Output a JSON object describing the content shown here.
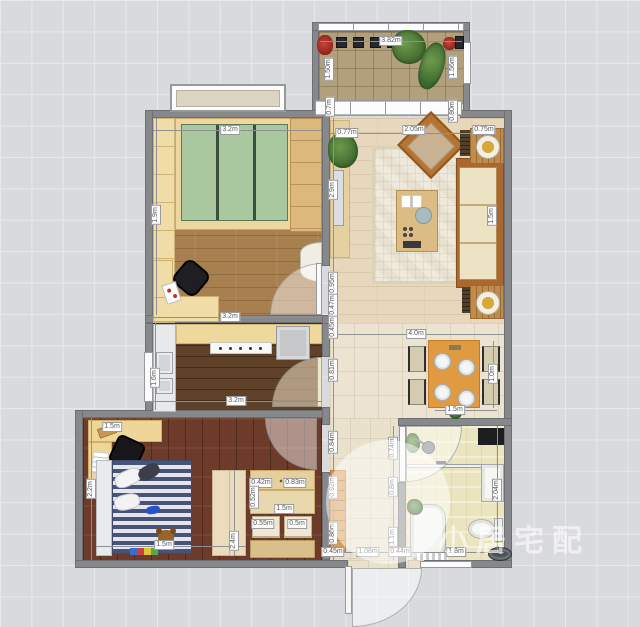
{
  "watermark": {
    "text": "小居宅配"
  },
  "colors": {
    "wall": "#87888c",
    "background_grid": "#d9dadd",
    "balcony_floor": "#b2a07c",
    "living_floor": "#e7d8bd",
    "dining_floor": "#ece4d1",
    "study_floor": "#a87f4f",
    "kitchen_floor": "#5f4129",
    "bedroom_floor": "#6e3b2a",
    "bathroom_floor": "#ebe5bf",
    "hall_floor": "#e9e1cb",
    "wardrobe_green": "#a9c8a0",
    "dining_table_orange": "#e09a42",
    "bed_stripe_blue": "#46537a",
    "watermark_white": "rgba(255,255,255,0.58)"
  },
  "furniture_icons": [
    "potted-plant-icon",
    "flower-pot-icon",
    "wardrobe-icon",
    "desk-icon",
    "office-chair-icon",
    "bay-window-icon",
    "tv-icon",
    "tv-console-icon",
    "rug-icon",
    "coffee-table-icon",
    "armchair-icon",
    "sofa-icon",
    "side-table-bowl-icon",
    "dining-table-icon",
    "dining-chair-icon",
    "plate-icon",
    "sink-icon",
    "stove-icon",
    "fridge-icon",
    "counter-icon",
    "bed-icon",
    "pillow-icon",
    "teddy-bear-icon",
    "toy-blocks-icon",
    "slipper-icon",
    "shoe-cabinet-icon",
    "door-swing-icon",
    "entry-door-icon",
    "shower-head-icon",
    "glass-partition-icon",
    "vanity-cabinet-icon",
    "toilet-icon",
    "washing-machine-icon",
    "bath-mat-icon",
    "floor-sink-icon",
    "window-icon"
  ],
  "dim_labels": [
    {
      "text": "3.82m",
      "x": 391,
      "y": 41,
      "v": false
    },
    {
      "text": "1.50m",
      "x": 329,
      "y": 69,
      "v": true
    },
    {
      "text": "1.56m",
      "x": 453,
      "y": 67,
      "v": true
    },
    {
      "text": "0.7m",
      "x": 330,
      "y": 107,
      "v": true
    },
    {
      "text": "0.80m",
      "x": 453,
      "y": 111,
      "v": true
    },
    {
      "text": "3.2m",
      "x": 230,
      "y": 130,
      "v": false
    },
    {
      "text": "3.2m",
      "x": 230,
      "y": 317,
      "v": false
    },
    {
      "text": "1.9m",
      "x": 156,
      "y": 215,
      "v": true
    },
    {
      "text": "0.77m",
      "x": 347,
      "y": 133,
      "v": false
    },
    {
      "text": "2.05m",
      "x": 414,
      "y": 130,
      "v": false
    },
    {
      "text": "0.75m",
      "x": 484,
      "y": 130,
      "v": false
    },
    {
      "text": "2.9m",
      "x": 333,
      "y": 190,
      "v": true
    },
    {
      "text": "1.5m",
      "x": 492,
      "y": 216,
      "v": true
    },
    {
      "text": "0.95m",
      "x": 333,
      "y": 283,
      "v": true
    },
    {
      "text": "0.47m",
      "x": 333,
      "y": 305,
      "v": true
    },
    {
      "text": "0.45m",
      "x": 333,
      "y": 327,
      "v": true
    },
    {
      "text": "0.81m",
      "x": 333,
      "y": 370,
      "v": true
    },
    {
      "text": "0.84m",
      "x": 333,
      "y": 442,
      "v": true
    },
    {
      "text": "0.92m",
      "x": 333,
      "y": 487,
      "v": true
    },
    {
      "text": "0.86m",
      "x": 333,
      "y": 533,
      "v": true
    },
    {
      "text": "4.0m",
      "x": 416,
      "y": 334,
      "v": false
    },
    {
      "text": "1.0m",
      "x": 493,
      "y": 374,
      "v": true
    },
    {
      "text": "1.5m",
      "x": 455,
      "y": 410,
      "v": false
    },
    {
      "text": "3.2m",
      "x": 236,
      "y": 401,
      "v": false
    },
    {
      "text": "1.6m",
      "x": 155,
      "y": 378,
      "v": true
    },
    {
      "text": "1.5m",
      "x": 112,
      "y": 427,
      "v": false
    },
    {
      "text": "2.2m",
      "x": 91,
      "y": 489,
      "v": true
    },
    {
      "text": "1.5m",
      "x": 164,
      "y": 545,
      "v": false
    },
    {
      "text": "2.4m",
      "x": 234,
      "y": 541,
      "v": true
    },
    {
      "text": "0.42m",
      "x": 261,
      "y": 483,
      "v": false
    },
    {
      "text": "0.83m",
      "x": 295,
      "y": 483,
      "v": false
    },
    {
      "text": "0.52m",
      "x": 254,
      "y": 497,
      "v": true
    },
    {
      "text": "1.5m",
      "x": 284,
      "y": 509,
      "v": false
    },
    {
      "text": "0.55m",
      "x": 263,
      "y": 524,
      "v": false
    },
    {
      "text": "0.5m",
      "x": 297,
      "y": 524,
      "v": false
    },
    {
      "text": "0.45m",
      "x": 333,
      "y": 552,
      "v": false
    },
    {
      "text": "1.08m",
      "x": 368,
      "y": 552,
      "v": false
    },
    {
      "text": "0.44m",
      "x": 400,
      "y": 552,
      "v": false
    },
    {
      "text": "0.74m",
      "x": 393,
      "y": 448,
      "v": true
    },
    {
      "text": "0.8m",
      "x": 393,
      "y": 487,
      "v": true
    },
    {
      "text": "1.1m",
      "x": 393,
      "y": 537,
      "v": true
    },
    {
      "text": "2.04m",
      "x": 497,
      "y": 490,
      "v": true
    },
    {
      "text": "1.8m",
      "x": 456,
      "y": 552,
      "v": false
    }
  ]
}
